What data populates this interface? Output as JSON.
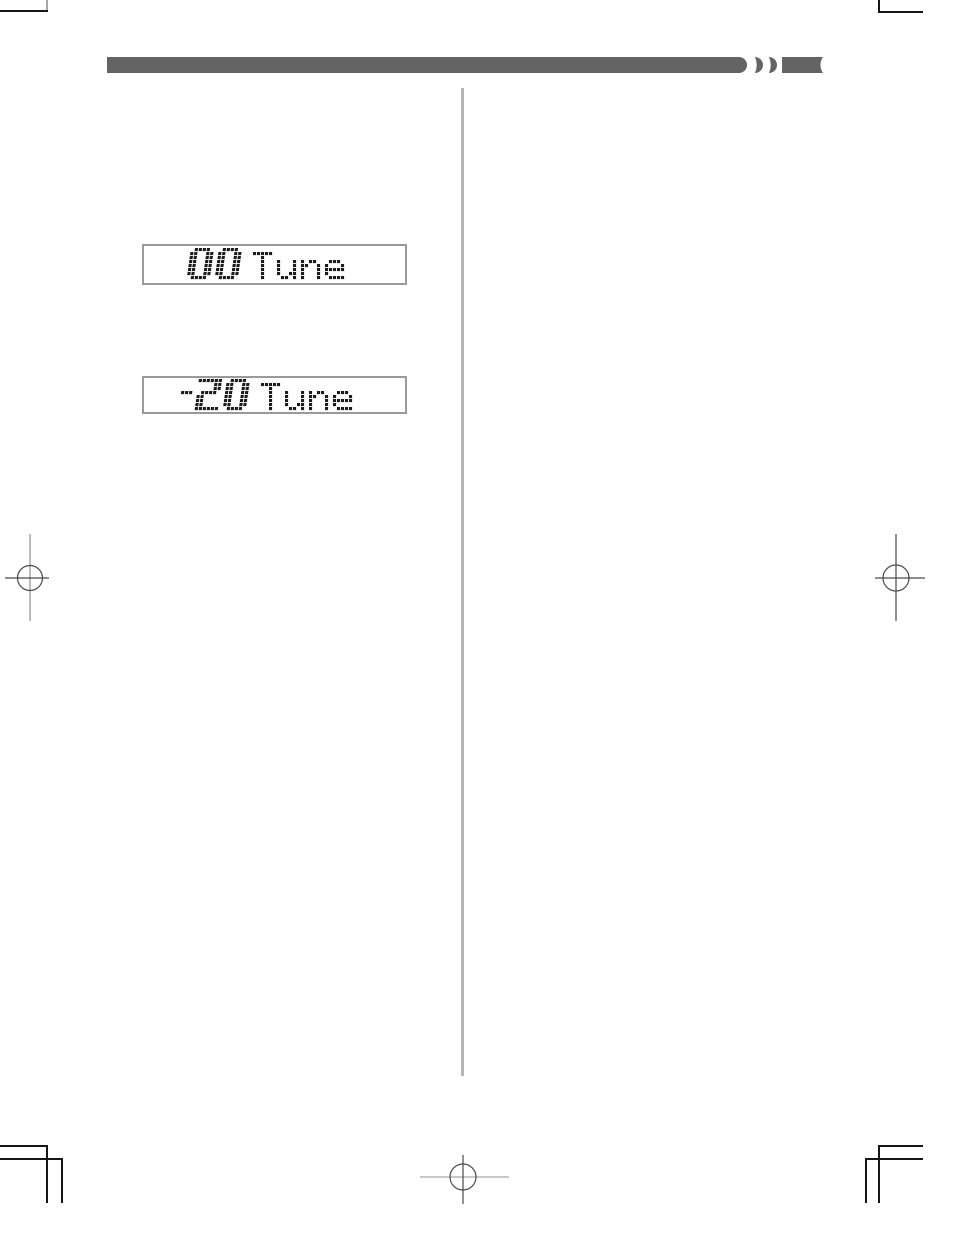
{
  "page": {
    "type": "instruction-manual-page",
    "background": "#ffffff"
  },
  "header_bar": {
    "color": "#646464"
  },
  "divider": {
    "color": "#b6b6b6"
  },
  "displays": [
    {
      "text": "00 Tune",
      "value": "00",
      "label": "Tune"
    },
    {
      "text": "-20 Tune",
      "value": "-20",
      "label": "Tune"
    }
  ],
  "lcd": {
    "text_color": "#1b1b1b",
    "border_color": "#9a9a9a"
  },
  "print_marks": {
    "trim_color": "#161616",
    "registration_color": "#4a4a4a",
    "bleed_line_color": "#a6a6a6"
  }
}
